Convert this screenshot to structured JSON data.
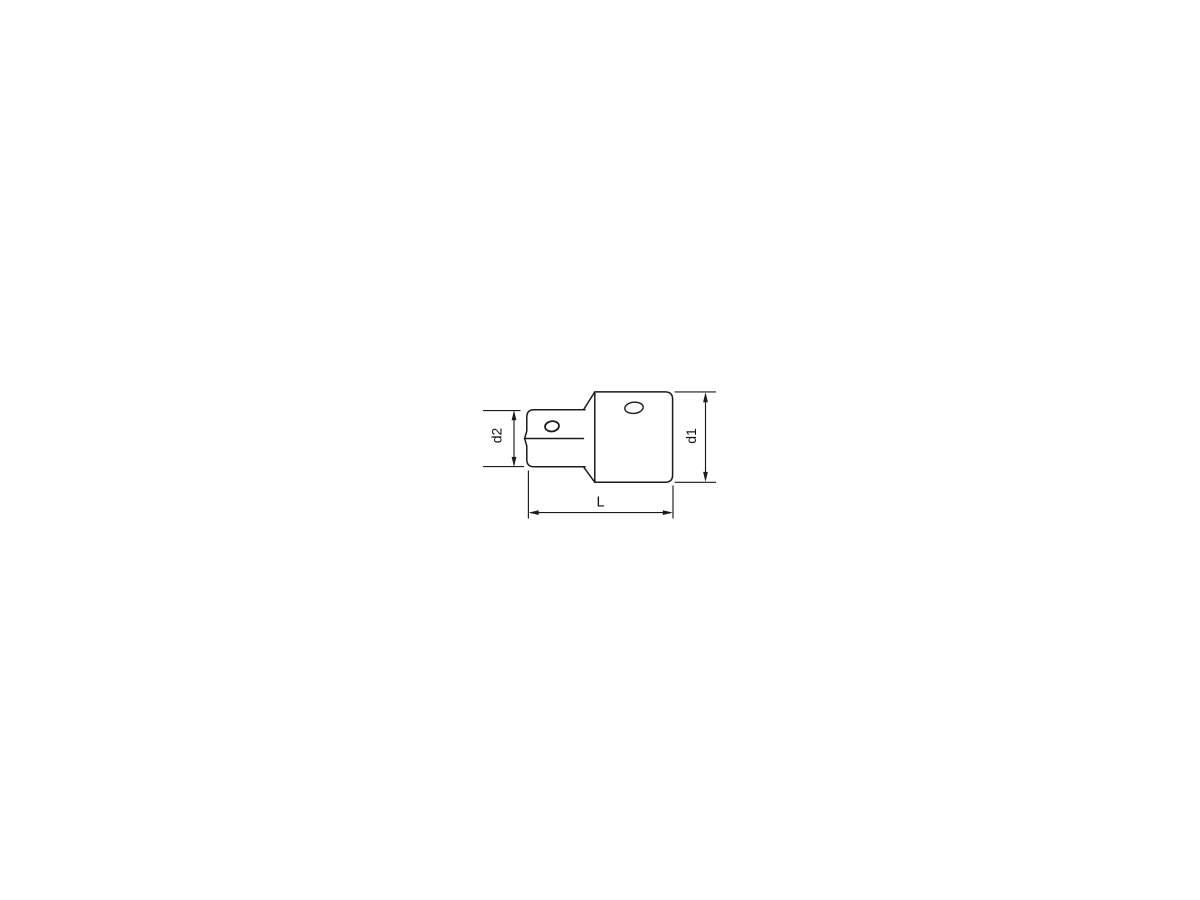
{
  "page": {
    "background_color": "#ffffff"
  },
  "drawing": {
    "kind": "technical-dimension-drawing",
    "subject": "socket-adapter-side-view",
    "stroke_color": "#1b1b1b",
    "labels": {
      "drive_diameter": "d2",
      "body_diameter": "d1",
      "overall_length": "L"
    }
  }
}
